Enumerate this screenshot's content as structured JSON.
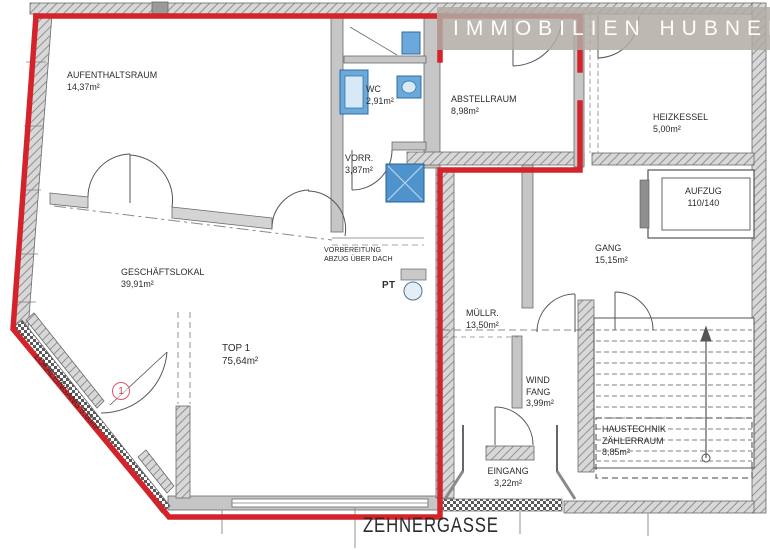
{
  "brand": {
    "name": "IMMOBILIEN HUBNER"
  },
  "street": {
    "label": "ZEHNERGASSE"
  },
  "unit_marker": {
    "number": "1"
  },
  "rooms": [
    {
      "id": "aufenthaltsraum",
      "label": "AUFENTHALTSRAUM\n14,37m²"
    },
    {
      "id": "wc",
      "label": "WC\n2,91m²"
    },
    {
      "id": "vorraum",
      "label": "VORR.\n3,87m²"
    },
    {
      "id": "abstellraum",
      "label": "ABSTELLRAUM\n8,98m²"
    },
    {
      "id": "heizkessel",
      "label": "HEIZKESSEL\n5,00m²"
    },
    {
      "id": "aufzug",
      "label": "AUFZUG\n110/140"
    },
    {
      "id": "gang",
      "label": "GANG\n15,15m²"
    },
    {
      "id": "vorbereitung",
      "label": "VORBEREITUNG\nABZUG ÜBER DACH"
    },
    {
      "id": "geschaeftslokal",
      "label": "GESCHÄFTSLOKAL\n39,91m²"
    },
    {
      "id": "pt",
      "label": "PT"
    },
    {
      "id": "muellraum",
      "label": "MÜLLR.\n13,50m²"
    },
    {
      "id": "top1",
      "label": "TOP 1\n75,64m²"
    },
    {
      "id": "windfang",
      "label": "WIND\nFANG\n3,99m²"
    },
    {
      "id": "lokaleingang",
      "label": "LOKALEINGANG 5,60m²"
    },
    {
      "id": "haustechnik",
      "label": "HAUSTECHNIK\nZÄHLERRAUM\n8,85m²"
    },
    {
      "id": "eingang",
      "label": "EINGANG\n3,22m²"
    }
  ],
  "colors": {
    "boundary_red": "#d4232a",
    "banner_gray": "#b2aba3",
    "fixture_blue": "#6aa9d9",
    "wall_gray": "#c6c6c6"
  }
}
